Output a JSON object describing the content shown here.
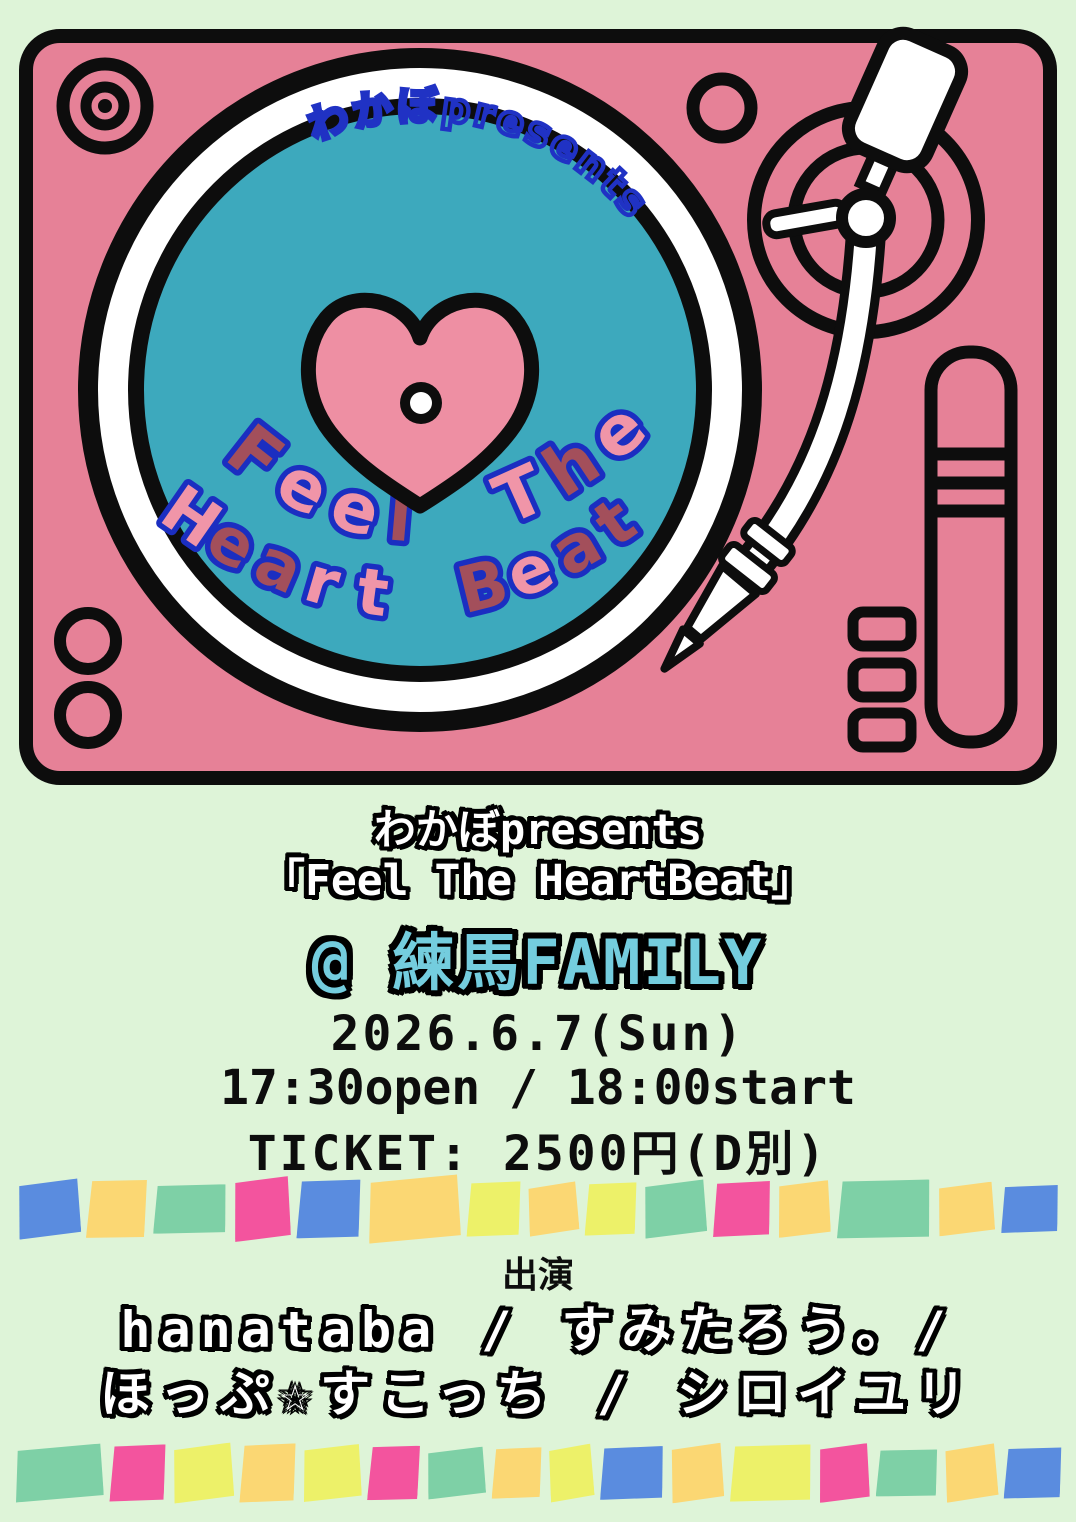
{
  "poster": {
    "background_color": "#def4d8",
    "info": {
      "title_line1": "わかぼpresents",
      "title_line2": "「Feel The HeartBeat」",
      "venue": "@ 練馬FAMILY",
      "date": "2026.6.7(Sun)",
      "time": "17:30open / 18:00start",
      "ticket": "TICKET: 2500円(D別)",
      "lineup_heading": "出演",
      "lineup_line1": "hanataba / すみたろう。/",
      "lineup_line2": "ほっぷ☆すこっち / シロイユリ"
    }
  },
  "turntable": {
    "body_color": "#e68197",
    "record_color": "#3da9bd",
    "heart_color": "#ee8fa3",
    "outline_color": "#0d0d0d",
    "label_arc_text": "わかぼpresents",
    "arc_text_color": "#2032c4",
    "letter_outline_color": "#1b2ec1",
    "letter_colors": {
      "dark": "#a34f5b",
      "pink": "#f095a8"
    },
    "bubble_line1": {
      "text": "Feel The",
      "letters": [
        {
          "ch": "F",
          "color": "dark"
        },
        {
          "ch": "e",
          "color": "pink"
        },
        {
          "ch": "e",
          "color": "pink"
        },
        {
          "ch": "l",
          "color": "dark"
        },
        {
          "ch": " ",
          "color": "pink"
        },
        {
          "ch": "T",
          "color": "pink"
        },
        {
          "ch": "h",
          "color": "dark"
        },
        {
          "ch": "e",
          "color": "pink"
        }
      ]
    },
    "bubble_line2": {
      "text": "Heart Beat",
      "letters": [
        {
          "ch": "H",
          "color": "pink"
        },
        {
          "ch": "e",
          "color": "dark"
        },
        {
          "ch": "a",
          "color": "dark"
        },
        {
          "ch": "r",
          "color": "pink"
        },
        {
          "ch": "t",
          "color": "pink"
        },
        {
          "ch": " ",
          "color": "pink"
        },
        {
          "ch": "B",
          "color": "dark"
        },
        {
          "ch": "e",
          "color": "pink"
        },
        {
          "ch": "a",
          "color": "dark"
        },
        {
          "ch": "t",
          "color": "dark"
        }
      ]
    }
  },
  "flags": {
    "colors": {
      "blue": "#5a8cdf",
      "yellow": "#fbd773",
      "mint": "#7ed0a6",
      "pink": "#f3549e",
      "ygreen": "#edf169"
    },
    "row1": [
      {
        "c": "blue",
        "w": 62,
        "h": 58,
        "r": -3
      },
      {
        "c": "yellow",
        "w": 58,
        "h": 62,
        "r": 4
      },
      {
        "c": "mint",
        "w": 72,
        "h": 52,
        "r": 2
      },
      {
        "c": "pink",
        "w": 56,
        "h": 64,
        "r": -2
      },
      {
        "c": "blue",
        "w": 62,
        "h": 62,
        "r": 3
      },
      {
        "c": "yellow",
        "w": 92,
        "h": 66,
        "r": -2
      },
      {
        "c": "ygreen",
        "w": 52,
        "h": 58,
        "r": 3
      },
      {
        "c": "yellow",
        "w": 50,
        "h": 52,
        "r": -4
      },
      {
        "c": "ygreen",
        "w": 50,
        "h": 56,
        "r": 3
      },
      {
        "c": "mint",
        "w": 62,
        "h": 56,
        "r": -3
      },
      {
        "c": "pink",
        "w": 56,
        "h": 58,
        "r": 2
      },
      {
        "c": "yellow",
        "w": 52,
        "h": 56,
        "r": -2
      },
      {
        "c": "mint",
        "w": 92,
        "h": 62,
        "r": 2
      },
      {
        "c": "yellow",
        "w": 56,
        "h": 52,
        "r": -3
      },
      {
        "c": "blue",
        "w": 56,
        "h": 50,
        "r": 2
      }
    ],
    "row2": [
      {
        "c": "mint",
        "w": 88,
        "h": 56,
        "r": -2
      },
      {
        "c": "pink",
        "w": 54,
        "h": 60,
        "r": 3
      },
      {
        "c": "ygreen",
        "w": 60,
        "h": 58,
        "r": -3
      },
      {
        "c": "yellow",
        "w": 54,
        "h": 62,
        "r": 3
      },
      {
        "c": "ygreen",
        "w": 58,
        "h": 56,
        "r": -2
      },
      {
        "c": "pink",
        "w": 50,
        "h": 58,
        "r": 4
      },
      {
        "c": "mint",
        "w": 58,
        "h": 50,
        "r": -3
      },
      {
        "c": "yellow",
        "w": 48,
        "h": 54,
        "r": 3
      },
      {
        "c": "ygreen",
        "w": 44,
        "h": 56,
        "r": -4
      },
      {
        "c": "blue",
        "w": 62,
        "h": 56,
        "r": 2
      },
      {
        "c": "yellow",
        "w": 52,
        "h": 58,
        "r": -3
      },
      {
        "c": "ygreen",
        "w": 80,
        "h": 60,
        "r": 2
      },
      {
        "c": "pink",
        "w": 50,
        "h": 58,
        "r": -2
      },
      {
        "c": "mint",
        "w": 60,
        "h": 50,
        "r": 3
      },
      {
        "c": "yellow",
        "w": 52,
        "h": 56,
        "r": -4
      },
      {
        "c": "blue",
        "w": 56,
        "h": 54,
        "r": 3
      }
    ]
  }
}
